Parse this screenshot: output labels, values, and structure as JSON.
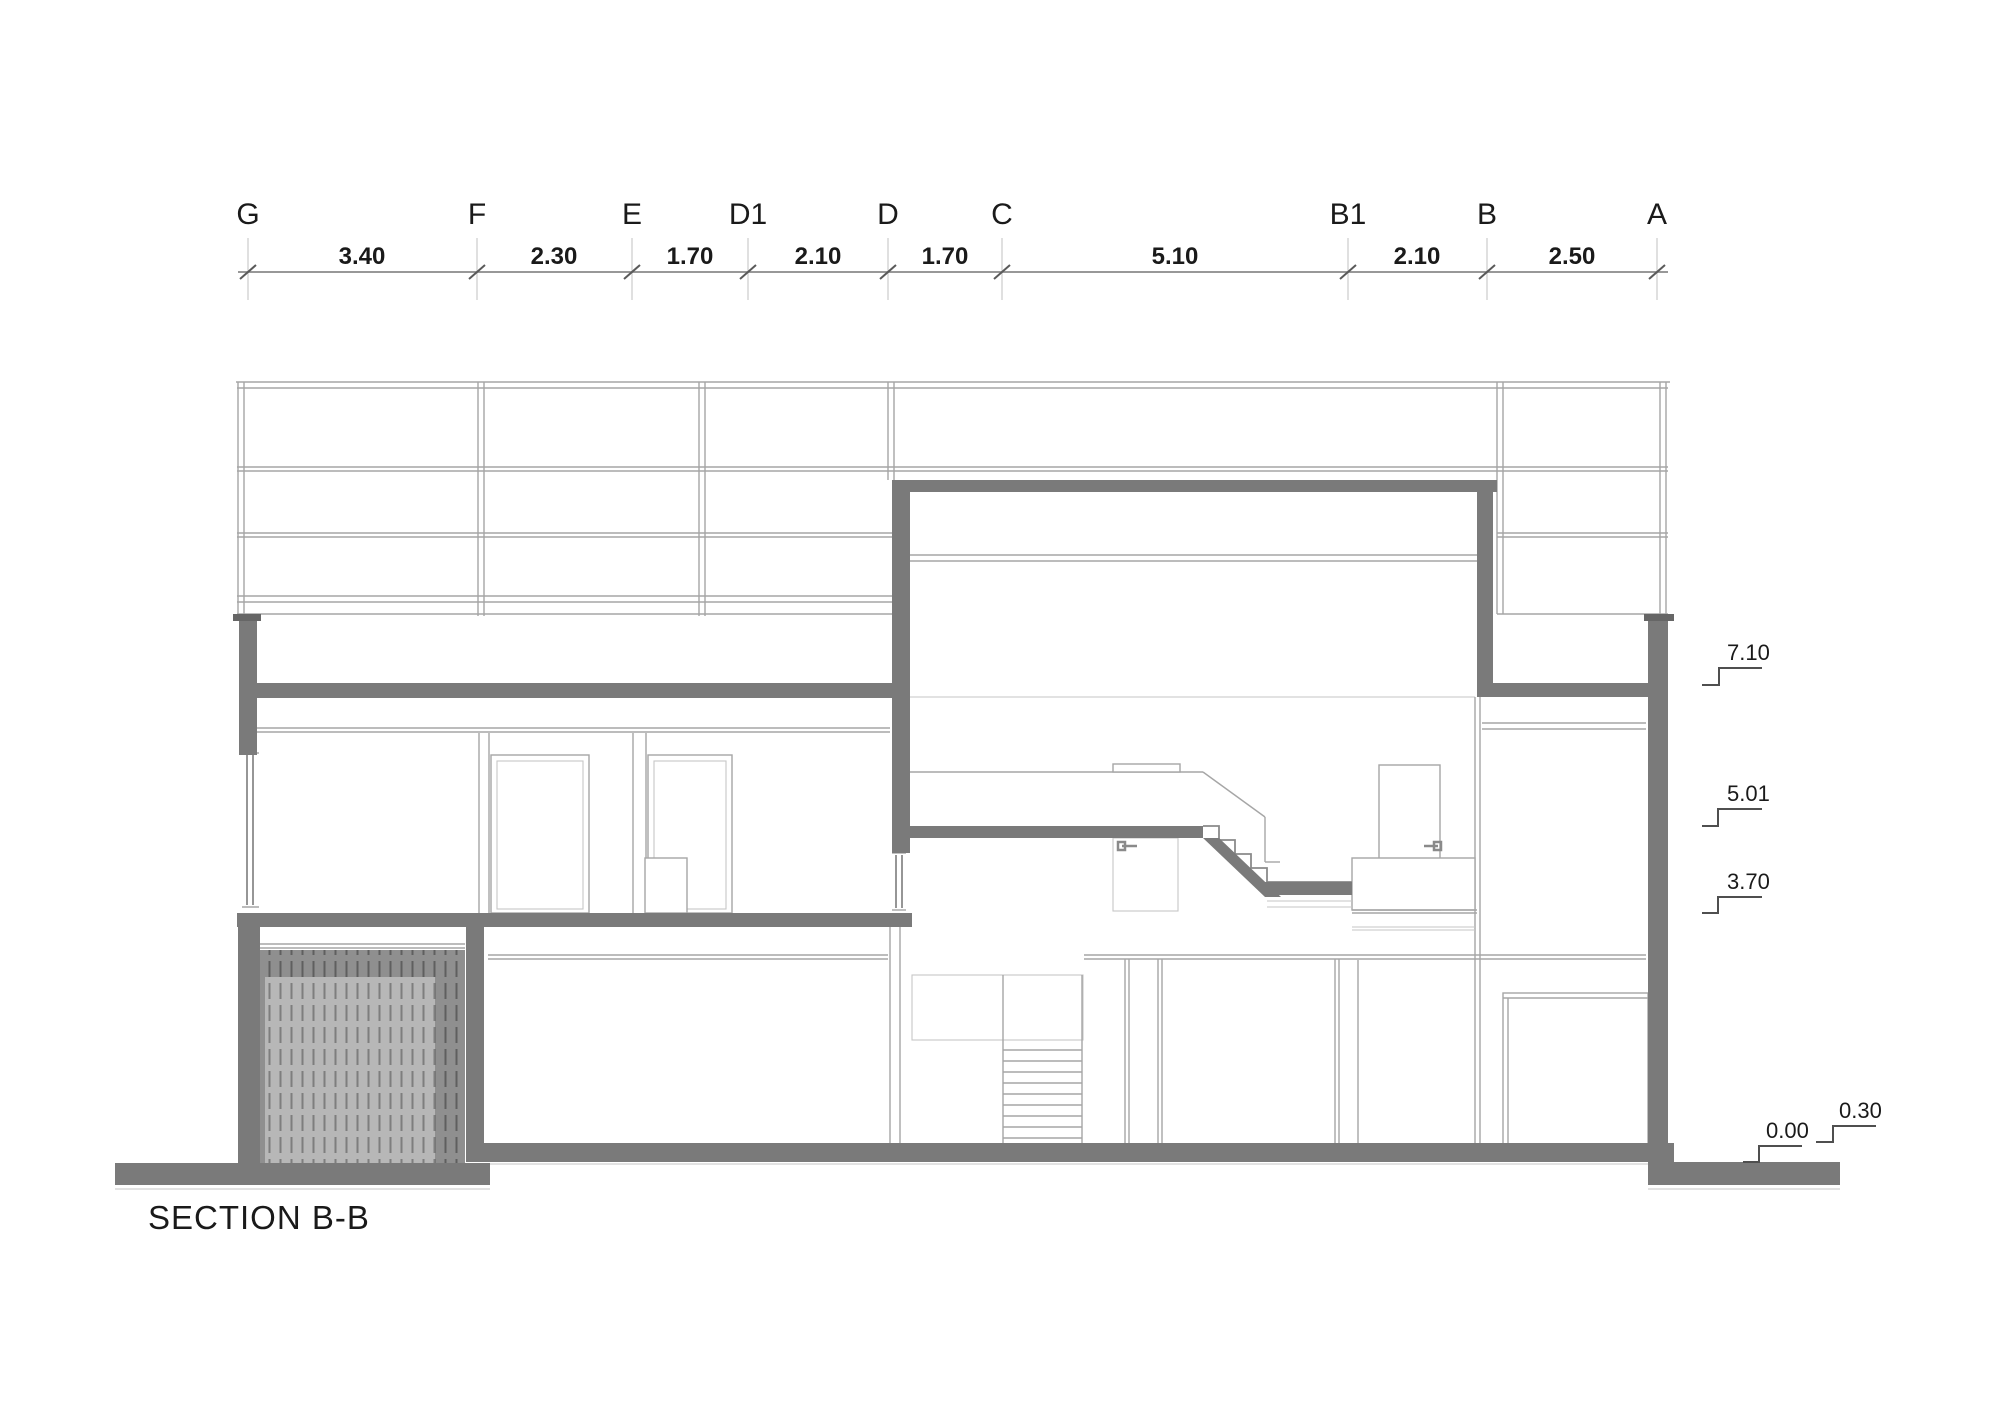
{
  "title": "SECTION B-B",
  "grid": {
    "labels": [
      "G",
      "F",
      "E",
      "D1",
      "D",
      "C",
      "B1",
      "B",
      "A"
    ]
  },
  "dimensions": {
    "values": [
      "3.40",
      "2.30",
      "1.70",
      "2.10",
      "1.70",
      "5.10",
      "2.10",
      "2.50"
    ]
  },
  "levels": {
    "values": [
      "7.10",
      "5.01",
      "3.70",
      "0.00",
      "0.30"
    ]
  },
  "colors": {
    "wall": "#7a7a7a",
    "wall_dark": "#666666",
    "hatch_outer": "#8f8f8f",
    "hatch_inner": "#b7b7b7",
    "line_thin": "#a6a6a6",
    "line_light": "#c6c6c6",
    "line_med": "#8a8a8a",
    "marker": "#4f4f4f",
    "ink": "#1a1a1a"
  }
}
